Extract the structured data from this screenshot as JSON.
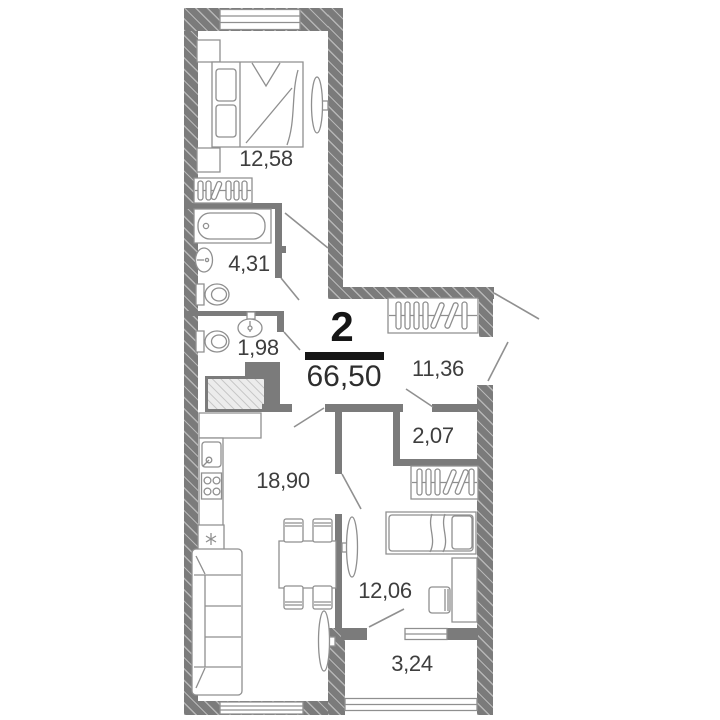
{
  "plan": {
    "room_count": "2",
    "total_area": "66,50",
    "rooms": [
      {
        "name": "bedroom-1",
        "area": "12,58"
      },
      {
        "name": "bathroom",
        "area": "4,31"
      },
      {
        "name": "wc",
        "area": "1,98"
      },
      {
        "name": "hallway",
        "area": "11,36"
      },
      {
        "name": "closet",
        "area": "2,07"
      },
      {
        "name": "kitchen-living",
        "area": "18,90"
      },
      {
        "name": "bedroom-2",
        "area": "12,06"
      },
      {
        "name": "balcony",
        "area": "3,24"
      }
    ],
    "icons": [
      "double-bed",
      "nightstand",
      "tv",
      "wardrobe-hangers",
      "bathtub",
      "washbasin",
      "toilet",
      "ventilation-shaft",
      "kitchen-counter",
      "kitchen-sink",
      "stove",
      "fridge",
      "sofa",
      "dining-table",
      "chair",
      "single-bed",
      "desk",
      "door-swing",
      "window"
    ],
    "colors": {
      "wall": "#7b7b7b",
      "furniture_line": "#8f8f8f",
      "text": "#3e3e3e",
      "accent": "#161616"
    }
  }
}
